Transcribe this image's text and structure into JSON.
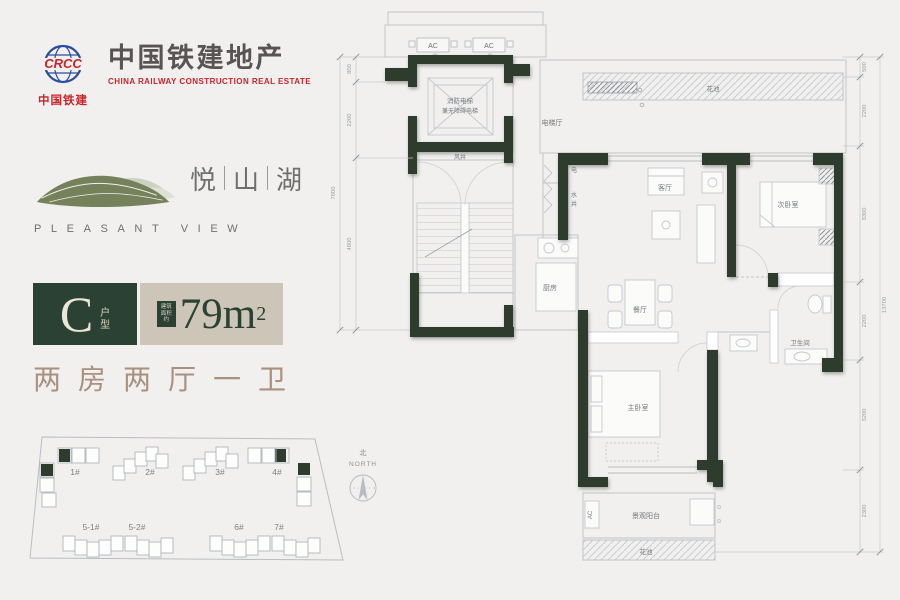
{
  "logo": {
    "company_zh": "中国铁建地产",
    "company_en": "CHINA RAILWAY CONSTRUCTION REAL ESTATE",
    "mark_zh": "中国铁建",
    "mark_en": "CRCC"
  },
  "brand": {
    "name_1": "悦",
    "name_2": "山",
    "name_3": "湖",
    "name_en": "PLEASANT VIEW"
  },
  "unit": {
    "type_letter": "C",
    "type_suffix_1": "户",
    "type_suffix_2": "型",
    "area_note_1": "建筑",
    "area_note_2": "面积",
    "area_note_3": "约",
    "area_value": "79m",
    "area_exponent": "2",
    "rooms_summary": "两房两厅一卫"
  },
  "site_plan": {
    "north_zh": "北",
    "north_en": "NORTH",
    "buildings": {
      "b1": "1#",
      "b2": "2#",
      "b3": "3#",
      "b4": "4#",
      "b51": "5-1#",
      "b52": "5-2#",
      "b6": "6#",
      "b7": "7#"
    }
  },
  "floor_plan": {
    "labels": {
      "ac": "AC",
      "fire_elevator_line1": "消防电梯",
      "fire_elevator_line2": "兼无障碍电梯",
      "elevator_hall": "电梯厅",
      "air_shaft": "风井",
      "electric": "电",
      "water_1": "水",
      "water_2": "井",
      "kitchen": "厨房",
      "living": "客厅",
      "dining": "餐厅",
      "bedroom2": "次卧室",
      "master": "主卧室",
      "bath": "卫生间",
      "balcony": "景观阳台",
      "flower_top": "花池",
      "flower_bottom": "花池"
    },
    "dims_left": {
      "d1": "800",
      "d2": "2200",
      "d3": "4800",
      "total": "7800"
    },
    "dims_right": {
      "d1": "500",
      "d2": "2200",
      "d3": "3300",
      "d4": "2200",
      "d5": "3200",
      "d6": "2300",
      "total": "13700"
    }
  }
}
